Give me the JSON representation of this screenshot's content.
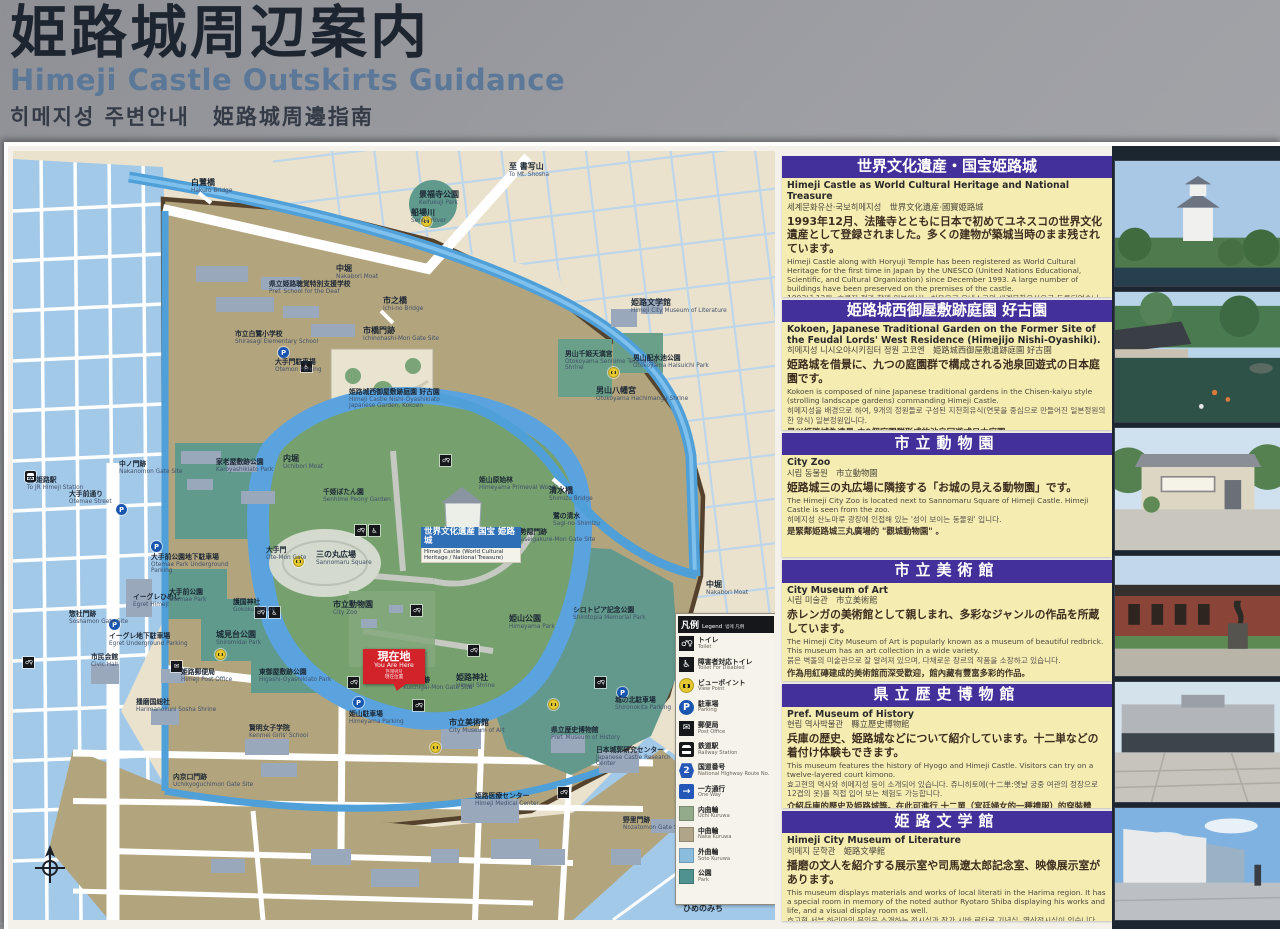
{
  "sign": {
    "title_ja": "姫路城周辺案内",
    "title_en": "Himeji Castle Outskirts Guidance",
    "title_krzh": "히메지성 주변안내　姫路城周邊指南"
  },
  "panels": [
    {
      "h": 141,
      "title_ja": "世界文化遺産・国宝姫路城",
      "en_title": "Himeji Castle as World Cultural Heritage and National Treasure",
      "kr_title": "세계문화유산·국보히메지성　世界文化遺産·國寶姫路城",
      "jp": "1993年12月、法隆寺とともに日本で初めてユネスコの世界文化遺産として登録されました。多くの建物が築城当時のまま残されています。",
      "en": "Himeji Castle along with Horyuji Temple has been registered as World Cultural Heritage for the first time in Japan by the UNESCO (United Nations Educational, Scientific, and Cultural Organization) since December 1993. A large number of buildings have been preserved on the premises of the castle.",
      "kr": "1993년 12월, 호류지 절과 함께 일본에서는 처음으로 유네스코의 세계문화유산으로 등록되었습니다. 상당수의 건물이 축성 당시의 모습 그대로 남아 있습니다.",
      "zh": "1993年12月·與法隆寺一起被登錄為日本第一批UNESCO的世界文化遺產·許多建築物仍保留著當初建城時的原貌·"
    },
    {
      "h": 130,
      "title_ja": "姫路城西御屋敷跡庭園 好古園",
      "en_title": "Kokoen, Japanese Traditional Garden on the Former Site of the Feudal Lords' West Residence (Himejijo Nishi-Oyashiki).",
      "kr_title": "히메지성 니시오야시키집터 정원 고코엔　姫路城西御屋敷遺跡庭園 好古園",
      "jp": "姫路城を借景に、九つの庭園群で構成される池泉回遊式の日本庭園です。",
      "en": "Kokoen is composed of nine Japanese traditional gardens in the Chisen-kaiyu style (strolling landscape gardens) commanding Himeji Castle.",
      "kr": "히메지성을 배경으로 하여, 9개의 정원들로 구성된 지천회유식(연못을 중심으로 만들어진 일본정원의 한 양식) 일본정원입니다.",
      "zh": "是以姫路城為遠景·由9個庭園群形成的池泉回遊式日本庭園·"
    },
    {
      "h": 125,
      "cls": "sp",
      "title_ja": "市立動物園",
      "en_title": "City Zoo",
      "kr_title": "시립 동물원　市立動物園",
      "jp": "姫路城三の丸広場に隣接する「お城の見える動物園」です。",
      "en": "The Himeji City Zoo is located next to Sannomaru Square of Himeji Castle. Himeji Castle is seen from the zoo.",
      "kr": "히메지성 산노마루 광장에 인접해 있는 '성이 보이는 동물원' 입니다.",
      "zh": "是緊鄰姫路城三丸廣場的 \"觀城動物園\" 。"
    },
    {
      "h": 121,
      "cls": "sp",
      "title_ja": "市立美術館",
      "en_title": "City Museum of Art",
      "kr_title": "시립 미술관　市立美術館",
      "jp": "赤レンガの美術館として親しまれ、多彩なジャンルの作品を所蔵しています。",
      "en": "The Himeji City Museum of Art is popularly known as a museum of beautiful redbrick. This museum has an art collection in a wide variety.",
      "kr": "붉은 벽돌의 미술관으로 잘 알려져 있으며, 다채로운 장르의 작품을 소장하고 있습니다.",
      "zh": "作為用紅磚建成的美術館而深受歡迎，館內藏有豐富多彩的作品。"
    },
    {
      "h": 124,
      "cls": "sp",
      "title_ja": "県立歴史博物館",
      "en_title": "Pref. Museum of History",
      "kr_title": "현립 역사박물관　縣立歷史博物館",
      "jp": "兵庫の歴史、姫路城などについて紹介しています。十二単などの着付け体験もできます。",
      "en": "This museum features the history of Hyogo and Himeji Castle. Visitors can try on a twelve-layered court kimono.",
      "kr": "효고현의 역사와 히메지성 등이 소개되어 있습니다. 쥬니히토에(十二単:옛날 궁중 여관의 정장으로 12겹의 옷)를 직접 입어 보는 체험도 가능합니다.",
      "zh": "介紹兵庫的歷史及姫路城等。在此可進行 十二單（宮廷婦女的一種禮服）的穿裝體驗。"
    },
    {
      "h": 110,
      "cls": "sp",
      "title_ja": "姫路文学館",
      "en_title": "Himeji City Museum of Literature",
      "kr_title": "히메지 문학관　姫路文學館",
      "jp": "播磨の文人を紹介する展示室や司馬遼太郎記念室、映像展示室があります。",
      "en": "This museum displays materials and works of local literati in the Harima region. It has a special room in memory of the noted author Ryotaro Shiba displaying his works and life, and a visual display room as well.",
      "kr": "효고현 서부 하리마의 문인을 소개하는 전시실과 작가 시바 료타로 기념실, 영상전시실이 있습니다.",
      "zh": "館內設有介紹播磨文人之展示室和司馬遼太郎紀念室、影像展示室。"
    }
  ],
  "legend": {
    "title_ja": "凡例",
    "title_en": "Legend",
    "title_krzh": "범례 凡例",
    "items": [
      {
        "t": "toilet",
        "ja": "トイレ",
        "en": "Toilet"
      },
      {
        "t": "disabled",
        "ja": "障害者対応トイレ",
        "en": "Toilet For Disabled"
      },
      {
        "t": "camera",
        "ja": "ビューポイント",
        "en": "View Point"
      },
      {
        "t": "parking",
        "ja": "駐車場",
        "en": "Parking"
      },
      {
        "t": "post",
        "ja": "郵便局",
        "en": "Post Office"
      },
      {
        "t": "train",
        "ja": "鉄道駅",
        "en": "Railway Station"
      },
      {
        "t": "route",
        "ja": "国道番号",
        "en": "National Highway Route No."
      },
      {
        "t": "oneway",
        "ja": "一方通行",
        "en": "One Way"
      },
      {
        "t": "swatch",
        "color": "#93aa8b",
        "ja": "内曲輪",
        "en": "Uchi Kuruwa"
      },
      {
        "t": "swatch",
        "color": "#b0a489",
        "ja": "中曲輪",
        "en": "Naka Kuruwa"
      },
      {
        "t": "swatch",
        "color": "#8abcde",
        "ja": "外曲輪",
        "en": "Soto Kuruwa"
      },
      {
        "t": "swatch",
        "color": "#4f9290",
        "ja": "公園",
        "en": "Park"
      }
    ]
  },
  "map": {
    "castle_label": {
      "ja": "世界文化遺産 国宝 姫路城",
      "en": "Himeji Castle (World Cultural Heritage / National Treasure)"
    },
    "you_are_here": {
      "ja": "現在地",
      "en": "You Are Here",
      "kr": "현재위치",
      "zh": "現在位置"
    },
    "hime_no_michi": "ひめのみち",
    "labels": [
      {
        "x": 178,
        "y": 28,
        "ja": "白鷺橋",
        "en": "Hakuro Bridge"
      },
      {
        "x": 398,
        "y": 58,
        "ja": "船場川",
        "en": "Senba River"
      },
      {
        "x": 496,
        "y": 12,
        "ja": "至 書写山",
        "en": "To Mt. Shosha"
      },
      {
        "x": 406,
        "y": 40,
        "ja": "景福寺公園",
        "en": "Keifukuji Park"
      },
      {
        "x": 618,
        "y": 148,
        "ja": "姫路文学館",
        "en": "Himeji City Museum of Literature"
      },
      {
        "x": 552,
        "y": 200,
        "ja": "男山千姫天満宮",
        "en": "Otokoyama Senhime Tenmangu Shrine",
        "cls": "sm"
      },
      {
        "x": 620,
        "y": 204,
        "ja": "男山配水池公園",
        "en": "Otokoyama Haisuichi Park",
        "cls": "sm"
      },
      {
        "x": 583,
        "y": 236,
        "ja": "男山八幡宮",
        "en": "Otokoyama Hachimangu Shrine"
      },
      {
        "x": 323,
        "y": 114,
        "ja": "中堀",
        "en": "Nakabori Moat"
      },
      {
        "x": 256,
        "y": 130,
        "ja": "県立姫路聴覚特別支援学校",
        "en": "Pref. School for the Deaf",
        "cls": "sm"
      },
      {
        "x": 222,
        "y": 180,
        "ja": "市立白鷺小学校",
        "en": "Shirasagi Elementary School",
        "cls": "sm"
      },
      {
        "x": 370,
        "y": 146,
        "ja": "市之橋",
        "en": "Ichi-no Bridge"
      },
      {
        "x": 350,
        "y": 176,
        "ja": "市橋門跡",
        "en": "Ichinohashi-Mon Gate Site"
      },
      {
        "x": 336,
        "y": 238,
        "ja": "姫路城西御屋敷跡庭園 好古園",
        "en": "Himeji Castle Nishi-Oyashikiato Japanese Garden, Kokoen",
        "cls": "sm"
      },
      {
        "x": 262,
        "y": 208,
        "ja": "大手門駐車場",
        "en": "Otemon Parking",
        "cls": "sm"
      },
      {
        "x": 203,
        "y": 308,
        "ja": "家老屋敷跡公園",
        "en": "Karoyashikiato Park",
        "cls": "sm"
      },
      {
        "x": 106,
        "y": 310,
        "ja": "中ノ門跡",
        "en": "Nakanomon Gate Site",
        "cls": "sm"
      },
      {
        "x": 14,
        "y": 326,
        "ja": "至 姫路駅",
        "en": "To JR Himeji Station",
        "cls": "sm"
      },
      {
        "x": 56,
        "y": 340,
        "ja": "大手前通り",
        "en": "Otemae Street",
        "cls": "sm"
      },
      {
        "x": 270,
        "y": 304,
        "ja": "内堀",
        "en": "Uchibori Moat"
      },
      {
        "x": 310,
        "y": 338,
        "ja": "千姫ぼたん園",
        "en": "Senhime Peony Garden",
        "cls": "sm"
      },
      {
        "x": 466,
        "y": 326,
        "ja": "姫山原始林",
        "en": "Himeyama Primeval Woods",
        "cls": "sm"
      },
      {
        "x": 303,
        "y": 400,
        "ja": "三の丸広場",
        "en": "Sannomaru Square"
      },
      {
        "x": 320,
        "y": 450,
        "ja": "市立動物園",
        "en": "City Zoo"
      },
      {
        "x": 536,
        "y": 336,
        "ja": "清水橋",
        "en": "Shimizu Bridge"
      },
      {
        "x": 540,
        "y": 362,
        "ja": "鷺の清水",
        "en": "Sagi-no-Shimizu",
        "cls": "sm"
      },
      {
        "x": 500,
        "y": 378,
        "ja": "北勢隠門跡",
        "en": "Kitaseigakure-Mon Gate Site",
        "cls": "sm"
      },
      {
        "x": 560,
        "y": 456,
        "ja": "シロトピア記念公園",
        "en": "Shirotopia Memorial Park",
        "cls": "sm"
      },
      {
        "x": 496,
        "y": 464,
        "ja": "姫山公園",
        "en": "Himeyama Park"
      },
      {
        "x": 693,
        "y": 430,
        "ja": "中堀",
        "en": "Nakabori Moat"
      },
      {
        "x": 602,
        "y": 546,
        "ja": "城の北駐車場",
        "en": "Shironokita Parking",
        "cls": "sm"
      },
      {
        "x": 443,
        "y": 523,
        "ja": "姫路神社",
        "en": "Himeji Shrine"
      },
      {
        "x": 390,
        "y": 526,
        "ja": "喰違門跡",
        "en": "Kuichigai-Mon Gate Site",
        "cls": "sm"
      },
      {
        "x": 336,
        "y": 560,
        "ja": "姫山駐車場",
        "en": "Himeyama Parking",
        "cls": "sm"
      },
      {
        "x": 436,
        "y": 568,
        "ja": "市立美術館",
        "en": "City Museum of Art"
      },
      {
        "x": 538,
        "y": 576,
        "ja": "県立歴史博物館",
        "en": "Pref. Museum of History",
        "cls": "sm"
      },
      {
        "x": 583,
        "y": 596,
        "ja": "日本城郭研究センター",
        "en": "Japanese Castle Research Center",
        "cls": "sm"
      },
      {
        "x": 462,
        "y": 642,
        "ja": "姫路医療センター",
        "en": "Himeji Medical Center",
        "cls": "sm"
      },
      {
        "x": 220,
        "y": 448,
        "ja": "護国神社",
        "en": "Gokoku Shrine",
        "cls": "sm"
      },
      {
        "x": 203,
        "y": 480,
        "ja": "城見台公園",
        "en": "Shiromidai Park"
      },
      {
        "x": 246,
        "y": 518,
        "ja": "東御屋敷跡公園",
        "en": "Higashi-Oyashikiato Park",
        "cls": "sm"
      },
      {
        "x": 168,
        "y": 518,
        "ja": "姫路郵便局",
        "en": "Himeji Post Office",
        "cls": "sm"
      },
      {
        "x": 236,
        "y": 574,
        "ja": "賢明女子学院",
        "en": "Kenmei Girls' School",
        "cls": "sm"
      },
      {
        "x": 123,
        "y": 548,
        "ja": "播磨国総社",
        "en": "Harimanokuni Sosha Shrine",
        "cls": "sm"
      },
      {
        "x": 78,
        "y": 503,
        "ja": "市民会館",
        "en": "Civic Hall",
        "cls": "sm"
      },
      {
        "x": 56,
        "y": 460,
        "ja": "惣社門跡",
        "en": "Soshamon Gate Site",
        "cls": "sm"
      },
      {
        "x": 96,
        "y": 482,
        "ja": "イーグレ地下駐車場",
        "en": "Egret Underground Parking",
        "cls": "sm"
      },
      {
        "x": 120,
        "y": 443,
        "ja": "イーグレひめじ",
        "en": "Egret Himeji",
        "cls": "sm"
      },
      {
        "x": 156,
        "y": 438,
        "ja": "大手前公園",
        "en": "Otemae Park",
        "cls": "sm"
      },
      {
        "x": 138,
        "y": 403,
        "ja": "大手前公園地下駐車場",
        "en": "Otemae Park Underground Parking",
        "cls": "sm"
      },
      {
        "x": 610,
        "y": 666,
        "ja": "野里門跡",
        "en": "Nozatomon Gate Site",
        "cls": "sm"
      },
      {
        "x": 160,
        "y": 623,
        "ja": "内京口門跡",
        "en": "Uchikyoguchimon Gate Site",
        "cls": "sm"
      },
      {
        "x": 253,
        "y": 396,
        "ja": "大手門",
        "en": "Ote-Mon Gate",
        "cls": "sm"
      },
      {
        "x": 670,
        "y": 754,
        "ja": "ひめのみち",
        "en": ""
      }
    ],
    "icons": [
      {
        "x": 408,
        "y": 65,
        "t": "camera"
      },
      {
        "x": 595,
        "y": 216,
        "t": "camera"
      },
      {
        "x": 280,
        "y": 405,
        "t": "camera"
      },
      {
        "x": 202,
        "y": 498,
        "t": "camera"
      },
      {
        "x": 535,
        "y": 548,
        "t": "camera"
      },
      {
        "x": 417,
        "y": 591,
        "t": "camera"
      },
      {
        "x": 265,
        "y": 196,
        "t": "parking"
      },
      {
        "x": 340,
        "y": 546,
        "t": "parking"
      },
      {
        "x": 604,
        "y": 536,
        "t": "parking"
      },
      {
        "x": 96,
        "y": 468,
        "t": "parking"
      },
      {
        "x": 138,
        "y": 390,
        "t": "parking"
      },
      {
        "x": 103,
        "y": 353,
        "t": "parking"
      },
      {
        "x": 427,
        "y": 304,
        "t": "toilet"
      },
      {
        "x": 342,
        "y": 374,
        "t": "toilet"
      },
      {
        "x": 398,
        "y": 454,
        "t": "toilet"
      },
      {
        "x": 455,
        "y": 494,
        "t": "toilet"
      },
      {
        "x": 582,
        "y": 526,
        "t": "toilet"
      },
      {
        "x": 335,
        "y": 526,
        "t": "toilet"
      },
      {
        "x": 242,
        "y": 456,
        "t": "toilet"
      },
      {
        "x": 10,
        "y": 506,
        "t": "toilet"
      },
      {
        "x": 400,
        "y": 549,
        "t": "toilet"
      },
      {
        "x": 545,
        "y": 636,
        "t": "toilet"
      },
      {
        "x": 356,
        "y": 374,
        "t": "disabled"
      },
      {
        "x": 256,
        "y": 456,
        "t": "disabled"
      },
      {
        "x": 288,
        "y": 210,
        "t": "disabled"
      },
      {
        "x": 158,
        "y": 510,
        "t": "post"
      },
      {
        "x": 12,
        "y": 320,
        "t": "train"
      }
    ]
  },
  "photos": [
    {
      "name": "himeji-castle"
    },
    {
      "name": "kokoen-garden"
    },
    {
      "name": "city-zoo"
    },
    {
      "name": "city-museum-of-art"
    },
    {
      "name": "pref-museum-of-history"
    },
    {
      "name": "himeji-city-museum-of-literature"
    }
  ],
  "icon_glyphs": {
    "toilet": "♂♀",
    "disabled-toilet": "♿",
    "viewpoint": "camera-shape",
    "parking": "P",
    "post-office": "✉",
    "railway-station": "train-shape",
    "route-number": "2",
    "one-way": "→"
  },
  "colors": {
    "panel_header": "#44309a",
    "panel_bg": "#f5ecb2",
    "marker_red": "#d2232a",
    "moat_blue": "#4f9fd8",
    "naka_kuruwa_tan": "#b2a47d",
    "soto_kuruwa_blue": "#a3c9e8",
    "park_teal": "#5f9a8d",
    "castle_green": "#76a16f",
    "castle_label_blue": "#2f6fb5",
    "photo_column_bg": "#1c2631"
  }
}
